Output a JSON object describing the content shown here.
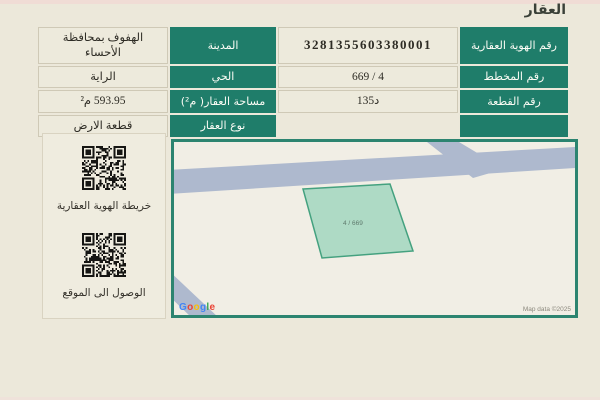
{
  "page": {
    "title": "العقار",
    "accent_color": "#1f7d6a",
    "map_border_color": "#2c8470",
    "background_color": "#ece8da"
  },
  "table": {
    "rows": [
      {
        "right_label": "رقم الهوية العقارية",
        "right_value": "3281355603380001",
        "left_label": "المدينة",
        "left_value": "الهفوف بمحافظة الأحساء"
      },
      {
        "right_label": "رقم المخطط",
        "right_value": "4 / 669",
        "left_label": "الحي",
        "left_value": "الراية"
      },
      {
        "right_label": "رقم القطعة",
        "right_value": "د135",
        "left_label": "مساحة العقار( م²)",
        "left_value": "593.95 م²"
      },
      {
        "right_label": "",
        "right_value": "",
        "left_label": "نوع العقار",
        "left_value": "قطعة الارض"
      }
    ]
  },
  "sidebar": {
    "qr1_label": "خريطة الهوية العقارية",
    "qr2_label": "الوصول الى الموقع"
  },
  "map": {
    "parcel_label": "4 / 669",
    "parcel_fill": "#a6d7c1",
    "parcel_stroke": "#44a17f",
    "road_color": "#aeb9ce",
    "attribution": "Map data ©2025",
    "google_letters": [
      {
        "ch": "G",
        "color": "#4285F4"
      },
      {
        "ch": "o",
        "color": "#EA4335"
      },
      {
        "ch": "o",
        "color": "#FBBC05"
      },
      {
        "ch": "g",
        "color": "#4285F4"
      },
      {
        "ch": "l",
        "color": "#34A853"
      },
      {
        "ch": "e",
        "color": "#EA4335"
      }
    ]
  }
}
